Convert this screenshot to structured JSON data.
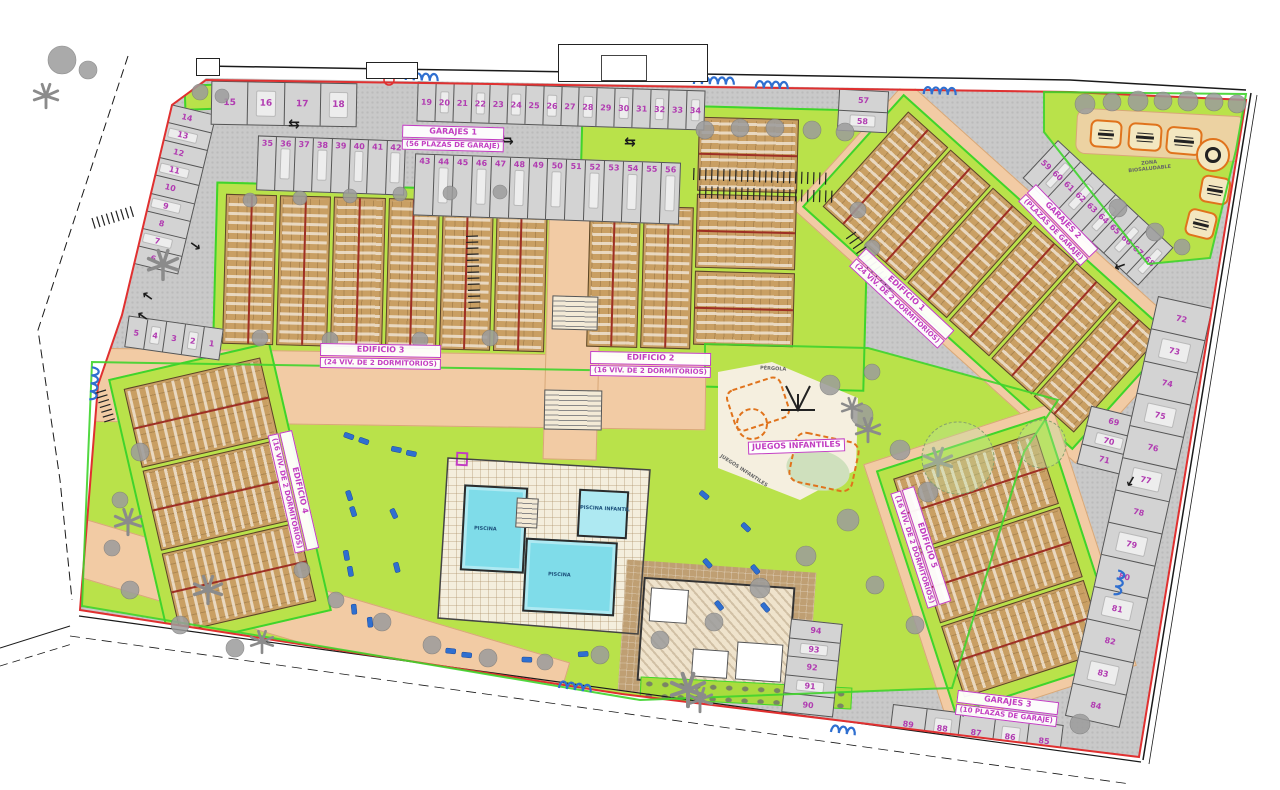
{
  "buildings": {
    "edificio1": {
      "name": "EDIFICIO 1",
      "units_label": "(24 VIV. DE 2 DORMITORIOS)"
    },
    "edificio2": {
      "name": "EDIFICIO 2",
      "units_label": "(16 VIV. DE 2 DORMITORIOS)"
    },
    "edificio3": {
      "name": "EDIFICIO 3",
      "units_label": "(24 VIV. DE 2 DORMITORIOS)"
    },
    "edificio4": {
      "name": "EDIFICIO 4",
      "units_label": "(16 VIV. DE 2 DORMITORIOS)"
    },
    "edificio5": {
      "name": "EDIFICIO 5",
      "units_label": "(16 VIV. DE 2 DORMITORIOS)"
    }
  },
  "garages": {
    "g1_l1": "GARAJES 1",
    "g1_l2": "(56 PLAZAS DE GARAJE)",
    "g2_l1": "GARAJES 2",
    "g2_l2": "(PLAZAS DE GARAJE)",
    "g3_l1": "GARAJES 3",
    "g3_l2": "(10 PLAZAS DE GARAJE)"
  },
  "areas": {
    "juegos_infantiles": "JUEGOS INFANTILES",
    "zona_biosaludable_l1": "ZONA",
    "zona_biosaludable_l2": "BIOSALUDABLE",
    "pergola": "PÉRGOLA",
    "piscina": "PISCINA",
    "piscina_infantil": "PISCINA INFANTIL"
  },
  "parking": {
    "left_column": [
      "14",
      "13",
      "12",
      "11",
      "10",
      "9",
      "8",
      "7",
      "6"
    ],
    "left_row": [
      "5",
      "4",
      "3",
      "2",
      "1"
    ],
    "top_row_a": [
      "15",
      "16",
      "17",
      "18"
    ],
    "top_row_b": [
      "19",
      "20",
      "21",
      "22",
      "23",
      "24",
      "25",
      "26",
      "27",
      "28",
      "29",
      "30",
      "31",
      "32",
      "33",
      "34"
    ],
    "mid_row_a": [
      "35",
      "36",
      "37",
      "38",
      "39",
      "40",
      "41",
      "42"
    ],
    "mid_row_b": [
      "43",
      "44",
      "45",
      "46",
      "47",
      "48",
      "49",
      "50",
      "51",
      "52",
      "53",
      "54",
      "55",
      "56"
    ],
    "right_pair": [
      "57",
      "58"
    ],
    "diagonal_row": [
      "59",
      "60",
      "61",
      "62",
      "63",
      "64",
      "65",
      "66",
      "67",
      "68"
    ],
    "pocket": [
      "69",
      "70",
      "71"
    ],
    "right_edge": [
      "72",
      "73",
      "74",
      "75",
      "76",
      "77",
      "78",
      "79",
      "80",
      "81",
      "82",
      "83",
      "84"
    ],
    "bottom_row": [
      "89",
      "88",
      "87",
      "86",
      "85"
    ],
    "bottom_stack": [
      "94",
      "93",
      "92",
      "91",
      "90"
    ]
  },
  "colors": {
    "boundary_red": "#e03030",
    "parcel_green": "#3fd42c",
    "lawn_lime": "#b9e24a",
    "road_gray": "#c9c9c9",
    "path_peach": "#f2cba4",
    "building_tan": "#c99f63",
    "pool_cyan": "#7fdce9",
    "label_magenta": "#c23ec2",
    "equipment_orange": "#e0731c",
    "lounger_blue": "#2f6fd0"
  }
}
